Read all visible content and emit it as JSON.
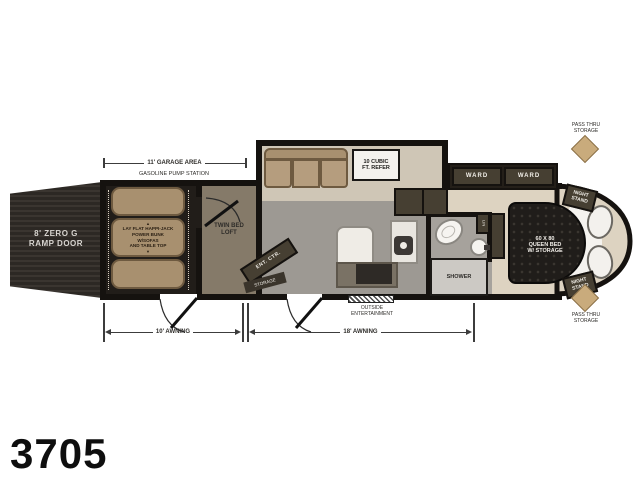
{
  "model": "3705",
  "colors": {
    "wall": "#15120f",
    "garage_floor": "#211d19",
    "living_floor": "#9d9993",
    "bedroom_floor": "#ddd3c1",
    "furniture_tan": "#a8906f",
    "dark_cabinet": "#463f32",
    "accent_tan": "#c9ab7c"
  },
  "exterior": {
    "ramp_door": {
      "line1": "8' ZERO G",
      "line2": "RAMP DOOR"
    },
    "garage_dim_label": "11' GARAGE AREA",
    "pump_station_label": "GASOLINE PUMP STATION",
    "awning_left": "10' AWNING",
    "awning_right": "18' AWNING",
    "outside_entertainment": {
      "line1": "OUTSIDE",
      "line2": "ENTERTAINMENT"
    },
    "pass_thru_top": {
      "line1": "PASS THRU",
      "line2": "STORAGE"
    },
    "pass_thru_bottom": {
      "line1": "PASS THRU",
      "line2": "STORAGE"
    }
  },
  "garage": {
    "bunk": {
      "arrow_up": "▲",
      "line1": "LAY FLAT HAPPI-JACK",
      "line2": "POWER BUNK",
      "line3": "W/SOFAS",
      "line4": "AND TABLE TOP",
      "arrow_down": "▼"
    }
  },
  "loft": {
    "line1": "TWIN BED",
    "line2": "LOFT"
  },
  "living": {
    "refer": {
      "line1": "10 CUBIC",
      "line2": "FT. REFER"
    },
    "ent_ctr": "ENT. CTR.",
    "storage": "STORAGE"
  },
  "bath": {
    "shower": "SHOWER",
    "linen": "LIN"
  },
  "bedroom": {
    "ward_left": "WARD",
    "ward_right": "WARD",
    "bed": {
      "line1": "60 X 80",
      "line2": "QUEEN BED",
      "line3": "W/ STORAGE"
    },
    "night_stand_top": {
      "line1": "NIGHT",
      "line2": "STAND"
    },
    "night_stand_bottom": {
      "line1": "NIGHT",
      "line2": "STAND"
    },
    "tv": "TV"
  }
}
